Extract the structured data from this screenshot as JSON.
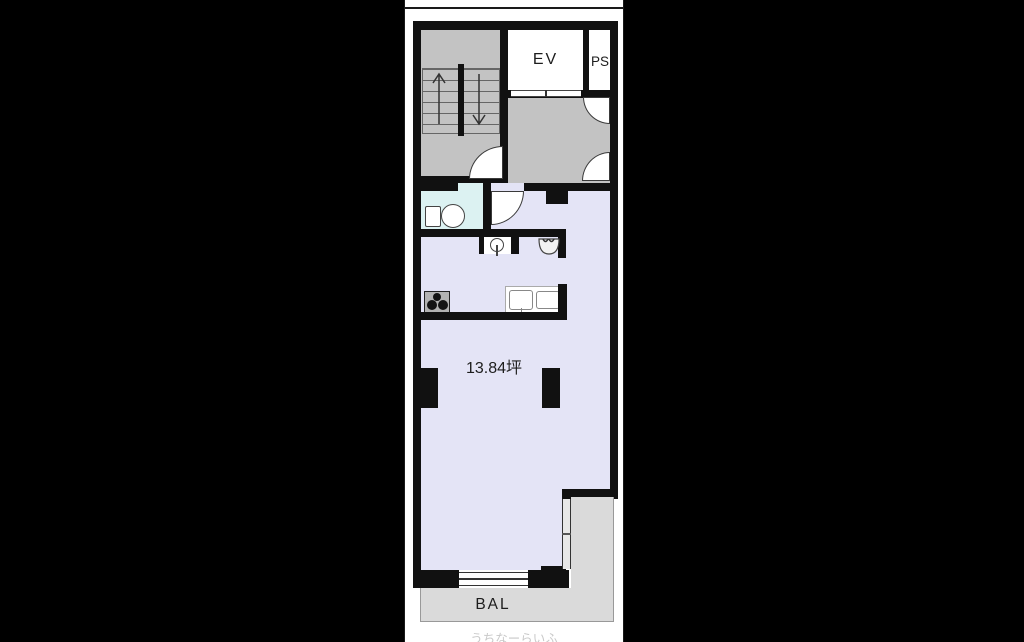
{
  "plan": {
    "labels": {
      "elevator": "EV",
      "pipe_space": "PS",
      "area": "13.84坪",
      "balcony": "BAL"
    },
    "watermark": "うちなーらいふ",
    "colors": {
      "background": "#000000",
      "paper": "#ffffff",
      "wall": "#111111",
      "main_room": "#e4e4f6",
      "toilet_room": "#dcf2f2",
      "stair_and_hall": "#c3c3c3",
      "balcony": "#dadada"
    },
    "icons": {
      "staircase": "stairs with up and down arrows",
      "entry_door": "quarter-circle door swing",
      "toilet": "tank and bowl",
      "washbasin": "round basin with faucet",
      "laundry_sink": "bowl with taps",
      "stove": "three burners",
      "kitchen_sink": "double counter sink",
      "window": "double-line sliding window"
    }
  }
}
